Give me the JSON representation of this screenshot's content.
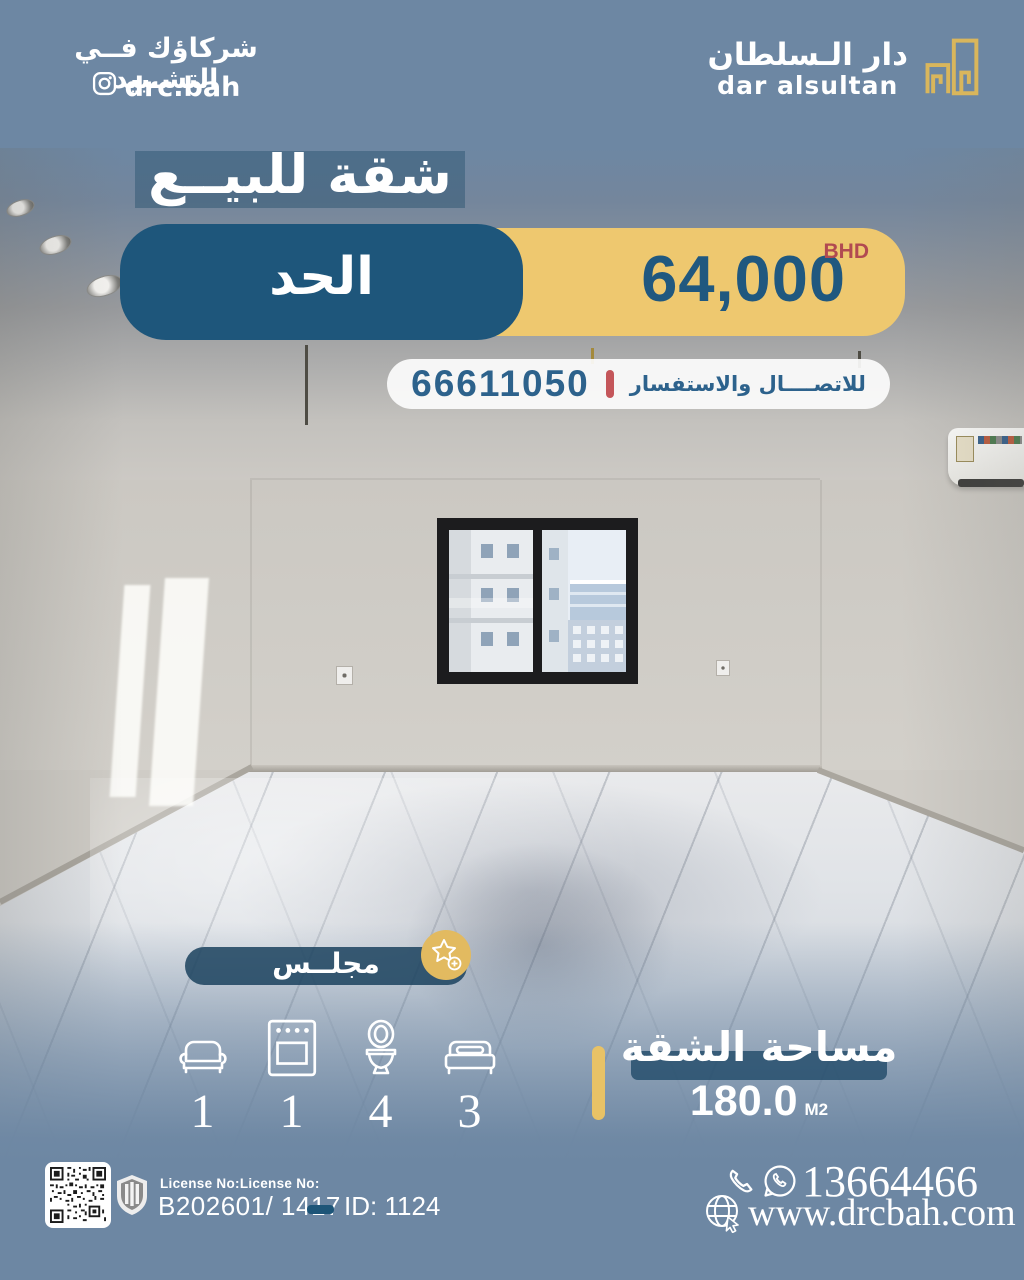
{
  "colors": {
    "background": "#6d87a3",
    "primary_blue": "#1e567b",
    "gold": "#eec86f",
    "accent_red": "#c4565a",
    "text_white": "#ffffff",
    "price_text": "#20587f"
  },
  "header": {
    "tagline": "شركاؤك فــي التشـييد",
    "instagram_handle": "drc.bah",
    "brand_name_ar": "دار الـسلطان",
    "brand_name_en": "dar alsultan"
  },
  "listing": {
    "title": "شقة للبيــع",
    "location": "الحد",
    "price": "64,000",
    "currency": "BHD",
    "contact_phone": "66611050",
    "contact_label": "للاتصــــال والاستفسار",
    "room_tag": "مجلــس"
  },
  "features": [
    {
      "name": "sofa",
      "count": "1"
    },
    {
      "name": "oven",
      "count": "1"
    },
    {
      "name": "toilet",
      "count": "4"
    },
    {
      "name": "bed",
      "count": "3"
    }
  ],
  "area": {
    "label": "مساحة الشقة",
    "value": "180.0",
    "unit": "M2"
  },
  "footer": {
    "license_label": "License No:License No:",
    "license_value": "B202601/ 1417",
    "listing_id": "ID: 1124",
    "phone": "13664466",
    "website": "www.drcbah.com"
  }
}
